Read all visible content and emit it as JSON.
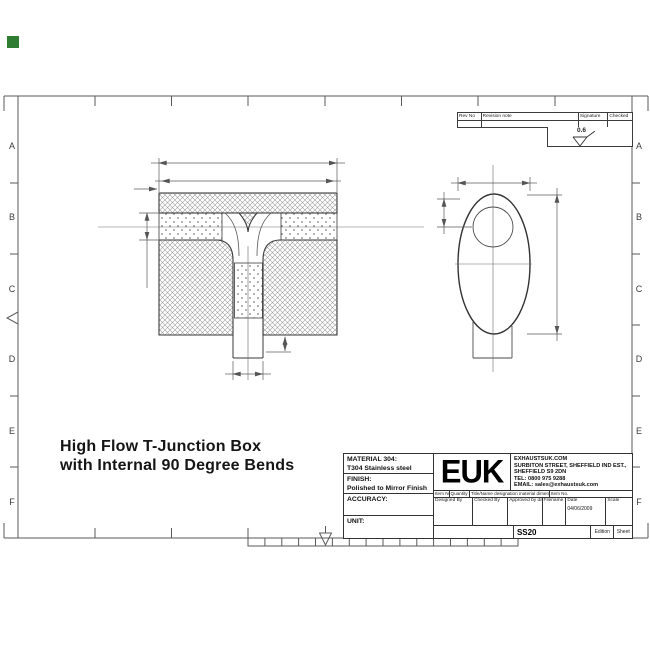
{
  "marker_color": "#2e7d32",
  "sheet": {
    "row_labels": [
      "A",
      "B",
      "C",
      "D",
      "E",
      "F"
    ],
    "title_line1": "High Flow T-Junction Box",
    "title_line2": "with Internal 90 Degree Bends"
  },
  "revision_table": {
    "col_rev_no": "Rev No",
    "col_revision_note": "Revision note",
    "col_signature": "Signature",
    "col_checked": "Checked"
  },
  "surface_finish": {
    "roughness_value": "0.6"
  },
  "title_block": {
    "material_label": "MATERIAL 304:",
    "material_value": "T304 Stainless steel",
    "finish_label": "FINISH:",
    "finish_value": "Polished to Mirror Finish",
    "accuracy_label": "ACCURACY:",
    "unit_label": "UNIT:",
    "logo_text": "EUK",
    "company": {
      "line1": "EXHAUSTSUK.COM",
      "line2": "SURBITON STREET, SHEFFIELD IND EST.,",
      "line3": "SHEFFIELD S9 2DN",
      "line4": "TEL: 0800 975 9288",
      "line5": "EMAIL: sales@exhaustsuk.com"
    },
    "item_header": {
      "item_no": "Item No",
      "quantity": "Quantity",
      "title_name": "Title/Name designation material dimensions",
      "item_no2": "Item No."
    },
    "sign_row": {
      "designed_by": "Designed By",
      "checked_by": "Checked By",
      "approved_by": "Approved by date",
      "filename": "Filename",
      "date": "Date",
      "scale": "Scale",
      "date_value": "04/06/2009"
    },
    "drawing_number": "SS20",
    "edition_label": "Edition",
    "sheet_label": "Sheet"
  }
}
